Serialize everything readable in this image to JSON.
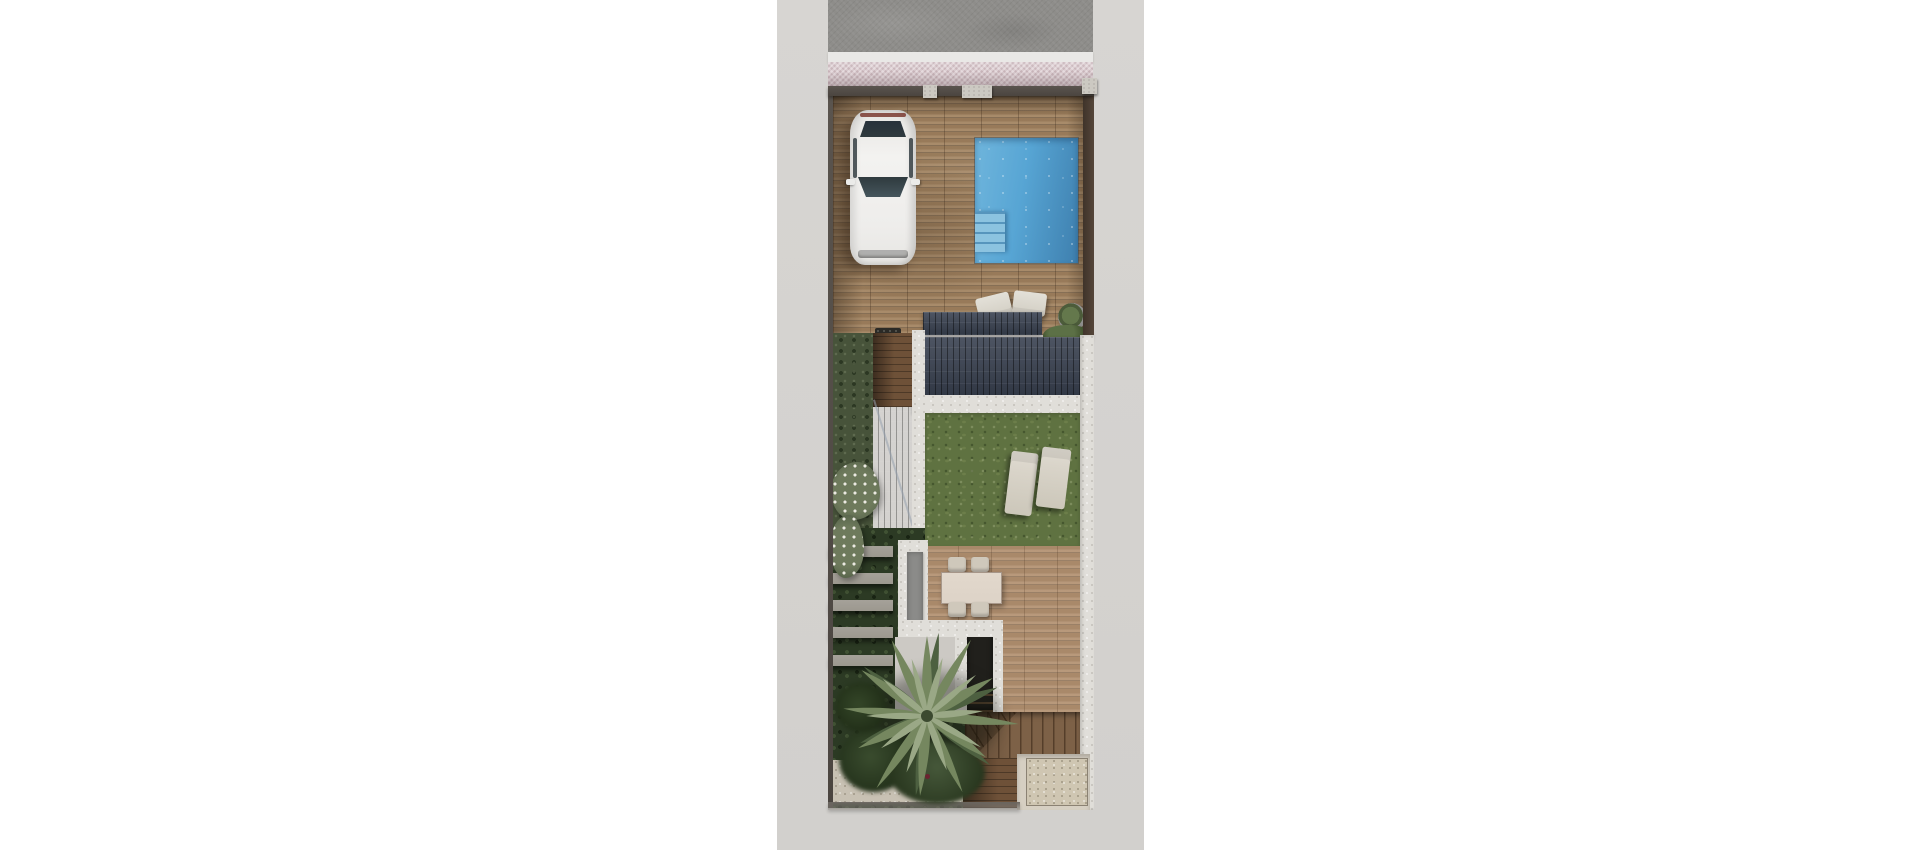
{
  "meta": {
    "description": "top-down 3D architectural render of a narrow residential plot",
    "canvas": {
      "width": 1920,
      "height": 850
    }
  },
  "colors": {
    "white-bg": "#ffffff",
    "ground": "#d5d3d0",
    "asphalt": "#8e8d8a",
    "curb": "#e9e8e6",
    "sidewalk": "#dccdd1",
    "wall": "#4b4540",
    "pillar": "#ccc9c2",
    "deck": "#a1825f",
    "terrace": "#b29070",
    "walkway": "#6e5138",
    "pool": "#57a5d4",
    "pool-deep": "#3e7fae",
    "pool-step": "#8cc3e0",
    "panel": "#394150",
    "roof-slope": "#3d4553",
    "white-wall": "#e0ded9",
    "lawn": "#5f7241",
    "hedge": "#47533a",
    "garden-dark": "#2c3a24",
    "slat": "#9c988f",
    "slab": "#8b8b89",
    "car": "#f3f2f0",
    "glass": "#2f3a3e",
    "tail": "#7a3a30",
    "lounger": "#d9d4c9",
    "table": "#ddd3c7",
    "chair": "#cfc8bb",
    "void": "#21201c",
    "stair": "#7d6147",
    "gravel": "#cfc6b2",
    "gravel-edge": "#8b8273",
    "palm-light": "#9aa886",
    "palm-mid": "#75875f",
    "palm-dark": "#4d6040",
    "pot": "#8f8f8d",
    "flower": "#ebe9e1"
  },
  "scene": {
    "environment": {
      "margins": "white",
      "ground": "light gray paving strip",
      "road": "asphalt street along top edge",
      "curb": "white curb line",
      "sidewalk": "pink woven-pattern sidewalk"
    },
    "plot": {
      "boundary": "dark perimeter wall with 2 light gate pillars",
      "front_deck": "wood plank driveway and pool deck",
      "car": {
        "type": "white car",
        "count": 1,
        "orientation": "parked nose-in from street"
      },
      "pool": {
        "shape": "rectangular",
        "steps": 4
      },
      "pool_cushions": 2,
      "plant_pot": 1,
      "solar_panel_roofs": 2,
      "sloped_dark_roof": 1,
      "side_garden": {
        "hedge": 1,
        "white_flowering_bushes": 2,
        "gray_pergola_slats": 5
      },
      "lawn": {
        "sun_loungers": 2
      },
      "terrace": {
        "dining_table": 1,
        "chairs": 4,
        "gray_slab": 1
      },
      "stairwell": "dark stair void with winder staircase",
      "entrance": {
        "wood_walkway": 1,
        "gravel_pad": 1
      },
      "palm_tree": 1
    }
  }
}
